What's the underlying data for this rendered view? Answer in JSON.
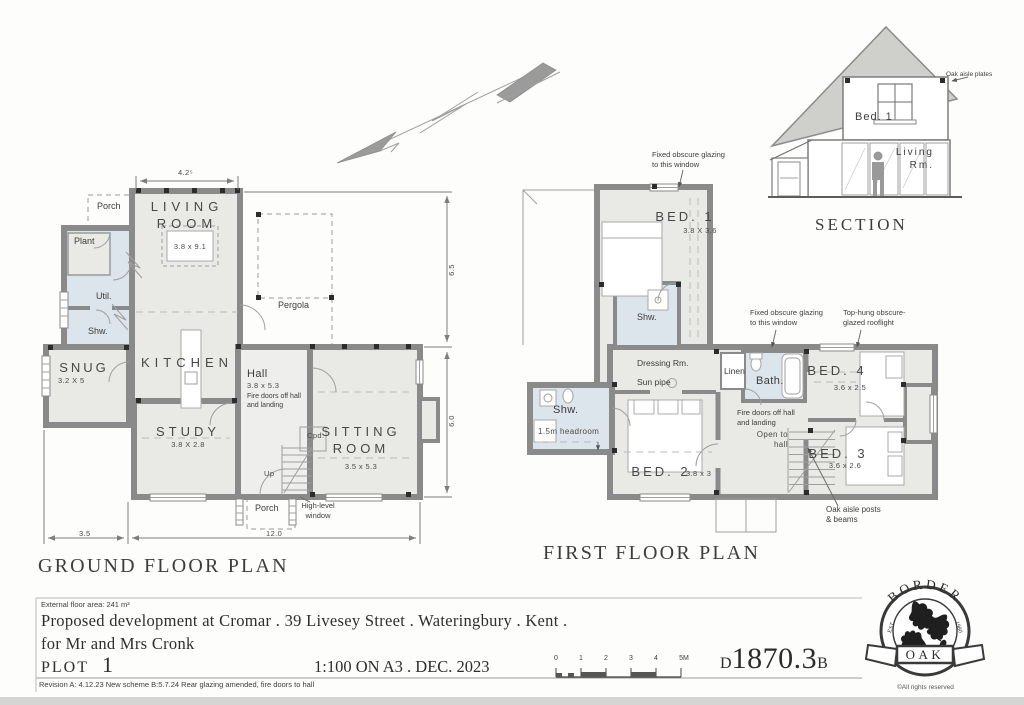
{
  "section_view": {
    "title": "SECTION",
    "bed1": "Bed. 1",
    "living": "Living\nRm.",
    "oak_plates": "Oak aisle plates"
  },
  "ground": {
    "title": "GROUND FLOOR PLAN",
    "living_name": "LIVING\nROOM",
    "living_dims": "3.8 x 9.1",
    "kitchen_name": "KITCHEN",
    "snug_name": "SNUG",
    "snug_dims": "3.2 X 5",
    "hall_name": "Hall",
    "hall_dims": "3.8 x 5.3",
    "hall_note": "Fire doors off hall\nand landing",
    "study_name": "STUDY",
    "study_dims": "3.8 X 2.8",
    "sitting_name": "SITTING\nROOM",
    "sitting_dims": "3.5 x 5.3",
    "util": "Util.",
    "shw": "Shw.",
    "plant": "Plant",
    "porch_top": "Porch",
    "porch_bottom": "Porch",
    "pergola": "Pergola",
    "cpd": "Cpd.",
    "up": "Up",
    "high_level": "High-level\nwindow",
    "dim_top": "4.2⁵",
    "dim_right_upper": "6.5",
    "dim_right_lower": "6.0",
    "dim_bottom_left": "3.5",
    "dim_bottom_right": "12.0"
  },
  "first": {
    "title": "FIRST FLOOR PLAN",
    "bed1_name": "BED. 1",
    "bed1_dims": "3.8 X 3.6",
    "bed2_name": "BED. 2",
    "bed2_dims": "3.8 x 3",
    "bed3_name": "BED. 3",
    "bed3_dims": "3.6 x 2.6",
    "bed4_name": "BED. 4",
    "bed4_dims": "3.6 x 2.5",
    "shw_top": "Shw.",
    "shw_left": "Shw.",
    "headroom": "1.5m headroom",
    "dressing": "Dressing Rm.",
    "sun_pipe": "Sun pipe",
    "linen": "Linen",
    "bath": "Bath.",
    "fire_note": "Fire doors off hall\nand landing",
    "open_hall": "Open to\nhall",
    "glazing_note_1": "Fixed obscure glazing\nto this window",
    "glazing_note_2": "Fixed obscure glazing\nto this window",
    "rooflight_note": "Top-hung obscure-\nglazed rooflight",
    "oak_posts_note": "Oak aisle posts\n& beams"
  },
  "title_block": {
    "floor_area": "External floor area: 241 m²",
    "line1": "Proposed development at Cromar . 39 Livesey Street . Wateringbury . Kent .",
    "line2": "for Mr and Mrs Cronk",
    "plot_label": "PLOT",
    "plot_number": "1",
    "scale_text": "1:100 ON A3 . DEC. 2023",
    "revision": "Revision A: 4.12.23 New scheme  B:5.7.24 Rear glazing amended, fire doors to hall",
    "drawing_prefix": "D",
    "drawing_number": "1870.3",
    "drawing_suffix": "B"
  },
  "scale_bar": {
    "ticks": [
      "0",
      "1",
      "2",
      "3",
      "4",
      "5M"
    ]
  },
  "logo": {
    "arc": "BORDER",
    "banner": "OAK",
    "est": "EST.",
    "year": "1980",
    "copyright": "©All rights reserved"
  },
  "colors": {
    "wall": "#8a8a8a",
    "room": "#e9e9e6",
    "wet": "#dce4ec",
    "ink": "#3d3d3d"
  }
}
